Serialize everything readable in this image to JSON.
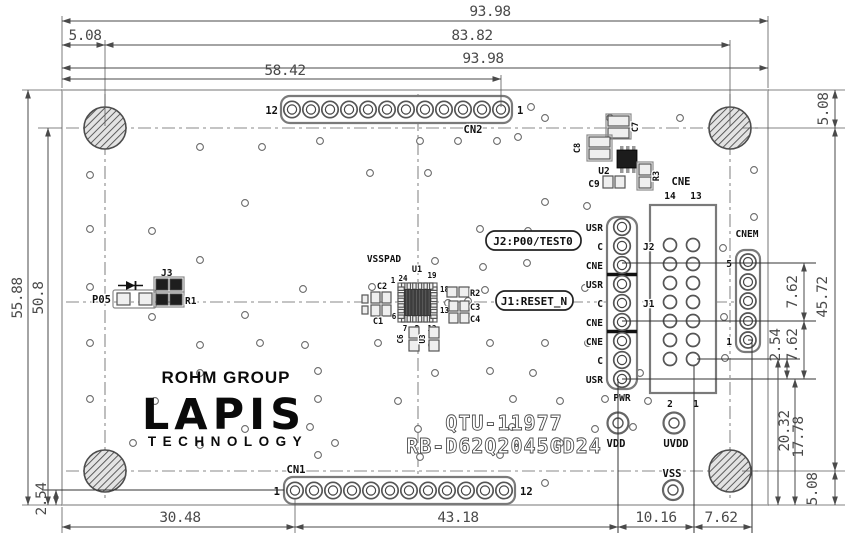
{
  "dimensions": {
    "overall_width_top": "93.98",
    "hole_left_offset": "5.08",
    "hole_span_x": "83.82",
    "overall_width_mid": "93.98",
    "cn2_pin1_x": "58.42",
    "overall_height": "55.88",
    "hole_col_height": "50.8",
    "cn1_row_offset": "2.54",
    "hole_top_offset": "5.08",
    "hole_span_y": "45.72",
    "cnem_pitch_upper": "7.62",
    "cnem_pitch_lower": "7.62",
    "cne_usr_gap": "2.54",
    "cne_pin1_to_bottom": "20.32",
    "usr_to_bottom": "17.78",
    "hole_bottom_offset": "5.08",
    "cn1_pin1_x": "30.48",
    "cn1_to_vdd": "43.18",
    "vdd_to_cne": "10.16",
    "cne_to_cnem": "7.62"
  },
  "connectors": {
    "cn2": {
      "label": "CN2",
      "left_pin": "12",
      "right_pin": "1"
    },
    "cn1": {
      "label": "CN1",
      "left_pin": "1",
      "right_pin": "12"
    },
    "cne": {
      "label": "CNE",
      "top_left": "14",
      "top_right": "13",
      "bottom_left": "2",
      "bottom_right": "1"
    },
    "cnem": {
      "label": "CNEM",
      "top_pin": "5",
      "bottom_pin": "1"
    }
  },
  "headers": {
    "j2": "J2",
    "j1": "J1",
    "pwr": "PWR",
    "pins": [
      "USR",
      "C",
      "CNE",
      "USR",
      "C",
      "CNE",
      "CNE",
      "C",
      "USR"
    ]
  },
  "callouts": {
    "j2": "J2:P00/TEST0",
    "j1": "J1:RESET_N"
  },
  "ic": {
    "ref": "U1",
    "pad_label": "VSSPAD",
    "pins": {
      "p24": "24",
      "p1": "1",
      "p19": "19",
      "p18": "18",
      "p13": "13",
      "p12": "12",
      "p7": "7",
      "p6": "6",
      "pp": "P"
    }
  },
  "components": {
    "c1": "C1",
    "c2": "C2",
    "r2": "R2",
    "c3": "C3",
    "c4": "C4",
    "c6": "C6",
    "u3": "U3",
    "p05": "P05",
    "j3": "J3",
    "r1": "R1",
    "c7": "C7",
    "c8": "C8",
    "u2": "U2",
    "r3": "R3",
    "c9": "C9"
  },
  "testpoints": {
    "vdd": "VDD",
    "uvdd": "UVDD",
    "vss": "VSS"
  },
  "logo": {
    "group": "ROHM GROUP",
    "brand": "LAPIS",
    "sub": "TECHNOLOGY"
  },
  "board_id": {
    "line1": "QTU-11977",
    "line2": "RB-D62Q2045GD24"
  }
}
